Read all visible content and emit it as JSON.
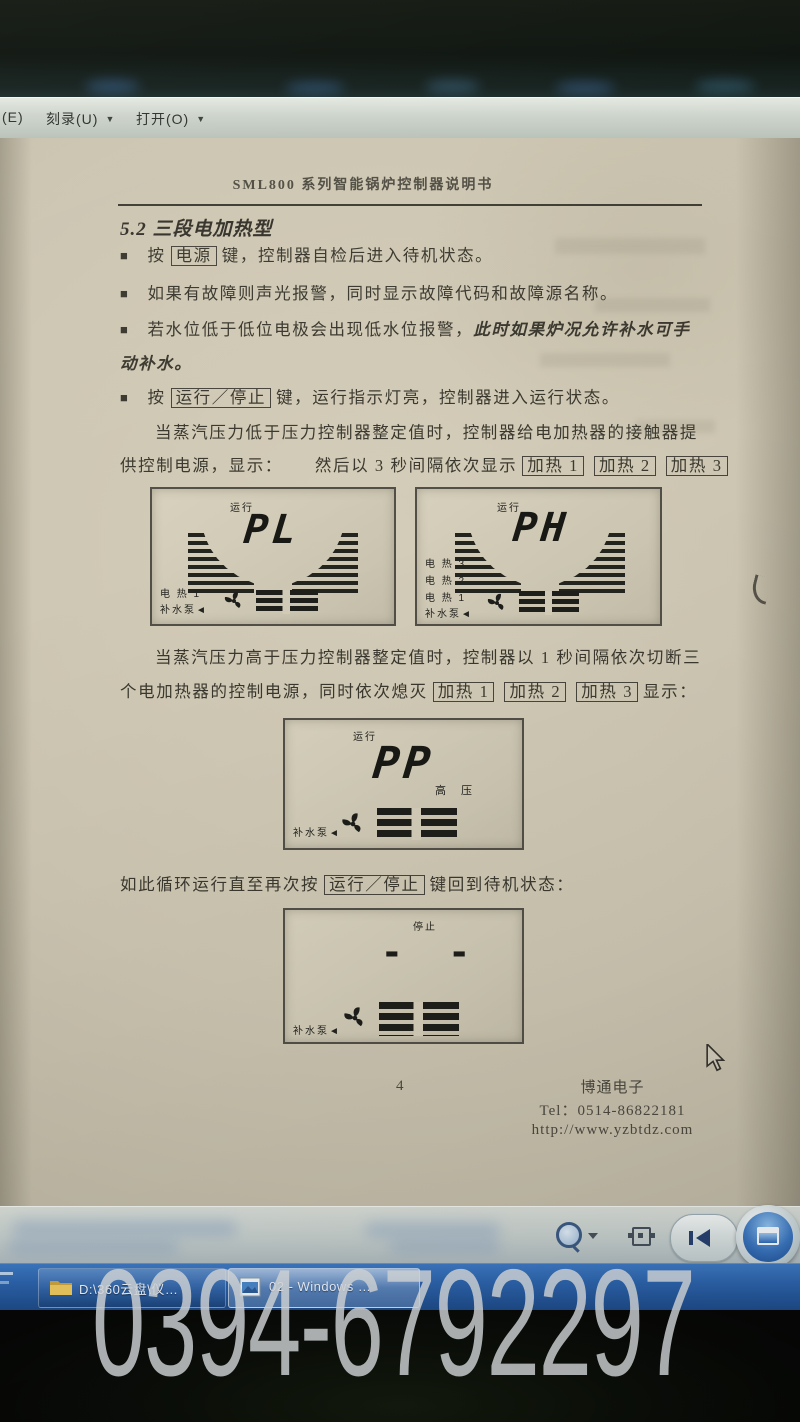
{
  "menu": {
    "items": [
      "(E)",
      "刻录(U)",
      "打开(O)"
    ]
  },
  "icons": {
    "caret": "▼",
    "bullet": "■"
  },
  "doc": {
    "header": "SML800 系列智能锅炉控制器说明书",
    "section": "5.2 三段电加热型",
    "b1_pre": "按",
    "b1_key": "电源",
    "b1_post": "键，控制器自检后进入待机状态。",
    "b2": "如果有故障则声光报警，同时显示故障代码和故障源名称。",
    "b3_normal": "若水位低于低位电极会出现低水位报警，",
    "b3_italic": "此时如果炉况允许补水可手",
    "b3_italic2": "动补水。",
    "b4_pre": "按",
    "b4_key": "运行／停止",
    "b4_post": "键，运行指示灯亮，控制器进入运行状态。",
    "p1_l1": "当蒸汽压力低于压力控制器整定值时，控制器给电加热器的接触器提",
    "p1_l2a": "供控制电源，显示：",
    "p1_l2b": "然后以 3 秒间隔依次显示",
    "heat_keys": [
      "加热 1",
      "加热 2",
      "加热 3"
    ],
    "p2_l1": "当蒸汽压力高于压力控制器整定值时，控制器以 1 秒间隔依次切断三",
    "p2_l2a": "个电加热器的控制电源，同时依次熄灭",
    "p2_l2b": "显示：",
    "p3_a": "如此循环运行直至再次按",
    "p3_key": "运行／停止",
    "p3_b": "键回到待机状态：",
    "footer_page": "4",
    "footer_company": "博通电子",
    "footer_tel": "Tel：0514-86822181",
    "footer_url": "http://www.yzbtdz.com"
  },
  "lcd": {
    "run": "运行",
    "stop": "停止",
    "pl": "PL",
    "ph": "PH",
    "pp": "PP",
    "dashes": "- -",
    "high_pressure": "高  压",
    "heat1": "电 热 1",
    "heat2": "电 热 2",
    "heat3": "电 热 3",
    "pump": "补水泵◄"
  },
  "taskbar": {
    "item1": "D:\\360云盘\\仪…",
    "item2": "02 - Windows …"
  },
  "watermark": "0394-6792297"
}
